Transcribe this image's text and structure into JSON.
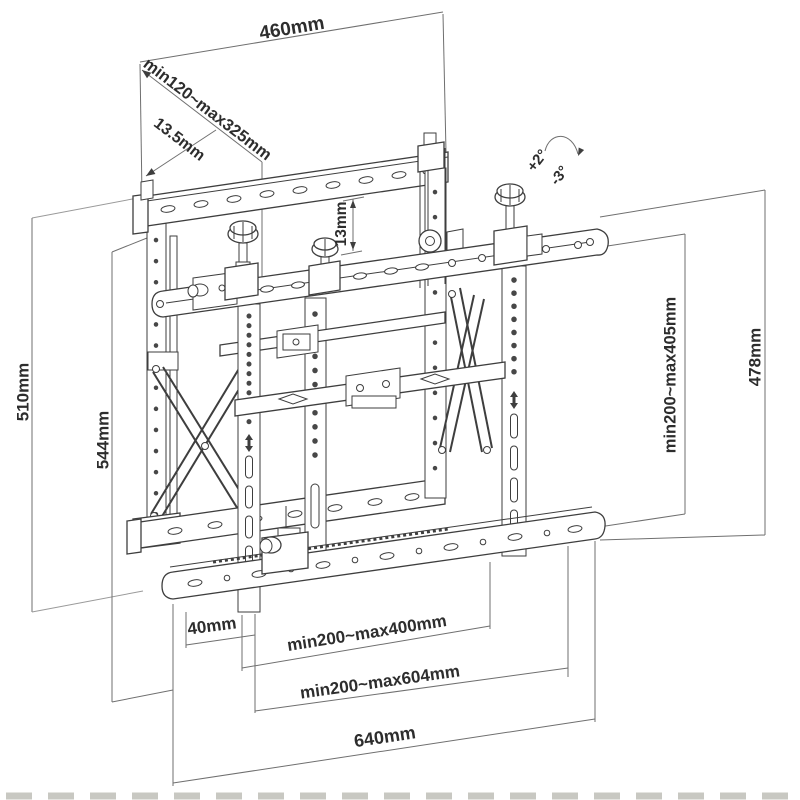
{
  "diagram": {
    "colors": {
      "background": "#ffffff",
      "drawing_line": "#3e3e3e",
      "dimension_line": "#6f6f6f",
      "label_text": "#2d2d2d"
    },
    "labels": {
      "width_top": "460mm",
      "depth_range": "min120~max325mm",
      "hook_depth": "13.5mm",
      "rail_gap": "13mm",
      "tilt_up": "+2°",
      "tilt_down": "-3°",
      "wall_plate_height": "510mm",
      "total_height_left": "544mm",
      "vesa_height_range": "min200~max405mm",
      "total_height_right": "478mm",
      "edge_offset": "40mm",
      "vesa_width_range": "min200~max400mm",
      "rail_width_range": "min200~max604mm",
      "total_width": "640mm"
    }
  }
}
